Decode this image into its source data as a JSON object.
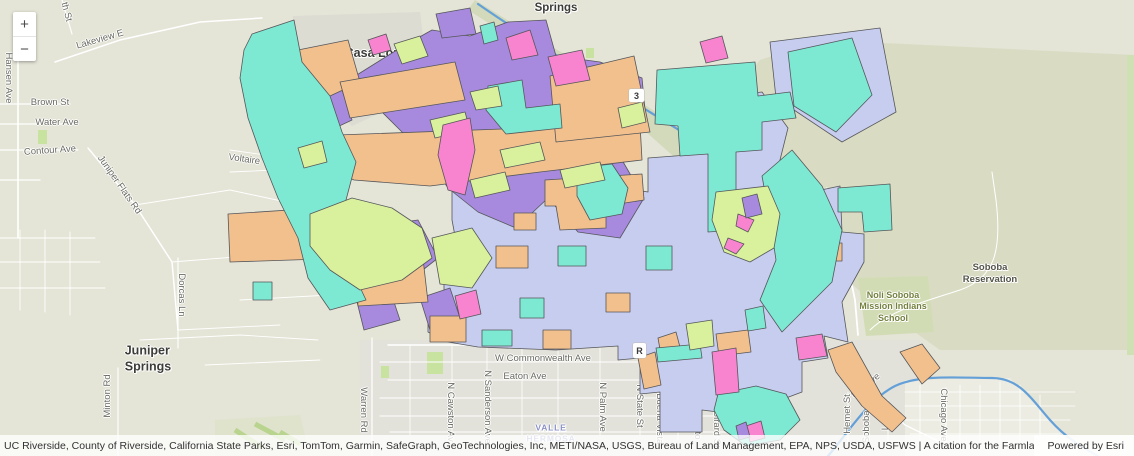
{
  "controls": {
    "zoom_in": "+",
    "zoom_out": "−"
  },
  "attribution": {
    "text": "UC Riverside, County of Riverside, California State Parks, Esri, TomTom, Garmin, SafeGraph, GeoTechnologies, Inc, METI/NASA, USGS, Bureau of Land Management, EPA, NPS, USDA, USFWS | A citation for the Farmland Mapping and Monitoring Program on an...",
    "powered_by": "Powered by Esri"
  },
  "shields": {
    "three": "3",
    "r": "R"
  },
  "labels": {
    "places": {
      "springs": "Springs",
      "casa_loma": "Casa Loma",
      "juniper_springs": "Juniper\nSprings",
      "soboba_reservation": "Soboba\nReservation",
      "school": "Noli Soboba\nMission Indians\nSchool",
      "soboba_h": "oboba H",
      "valle_hermosa": "VALLE\nHERMOSA"
    },
    "streets": {
      "hansen": "Hansen Ave",
      "th_st": "th St",
      "lakeview": "Lakeview E",
      "brown": "Brown St",
      "water": "Water Ave",
      "contour": "Contour Ave",
      "juniper_flats": "Juniper Flats Rd",
      "voltaire": "Voltaire Vis",
      "dorcas": "Dorcas Ln",
      "minton": "Minton Rd",
      "warren": "Warren Rd",
      "soboba_rd": "Soboba Rd",
      "expy": "a Expy",
      "esplanade": "W Esplanade Ave",
      "commonwealth": "W Commonwealth Ave",
      "eaton": "Eaton Ave",
      "cawston": "N Cawston Av",
      "sanderson": "N Sanderson Ave",
      "palm": "N Palm Ave",
      "state": "N State St",
      "buena_vista": "N Buena Vista",
      "santa_fe": "N Santa Fe St",
      "san_jacinto": "N San Jacinto",
      "girard": "N Girard St",
      "hemet": "Hemet St",
      "soboba_st": "Soboba St",
      "lake": "Lake",
      "mountain": "tain Ave",
      "chicago": "Chicago Ave"
    }
  },
  "map_colors": {
    "base": "#e4e4d7",
    "terrain_dark": "#d9dcc2",
    "river_band": "#d3d9bb",
    "urban_base": "#e3e2da",
    "urban_bright": "#edece3",
    "gray_patch": "#dddcd3",
    "park": "#c8e3a0",
    "river": "#64a0d8",
    "teal": "#7de9d3",
    "purple": "#a78ade",
    "orange": "#f2c08d",
    "lime": "#d9f19c",
    "pink": "#f884cf",
    "lavender": "#c7cdee",
    "outline": "#55565a"
  }
}
